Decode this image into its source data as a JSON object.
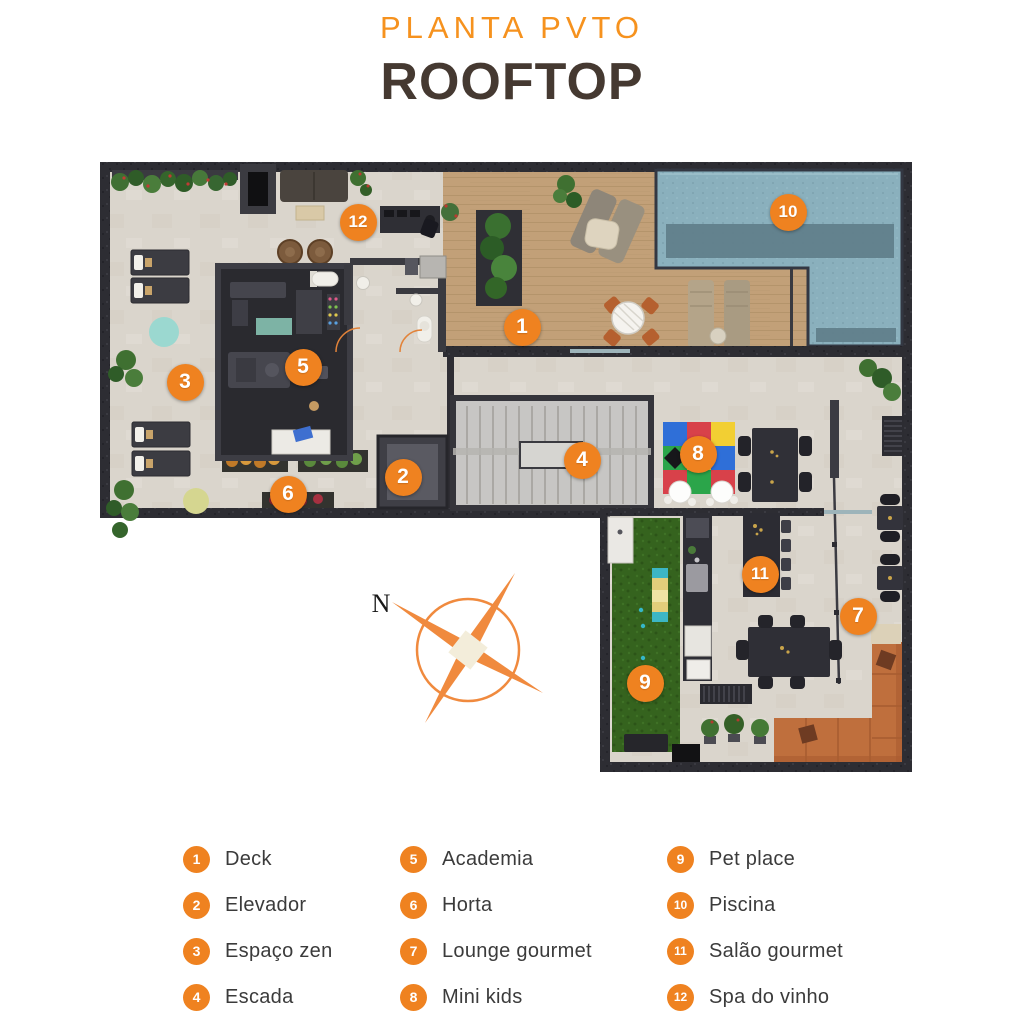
{
  "header": {
    "subtitle": "PLANTA PVTO",
    "title": "ROOFTOP"
  },
  "compass": {
    "north_label": "N"
  },
  "legend": {
    "items": [
      {
        "number": "1",
        "label": "Deck"
      },
      {
        "number": "2",
        "label": "Elevador"
      },
      {
        "number": "3",
        "label": "Espaço zen"
      },
      {
        "number": "4",
        "label": "Escada"
      },
      {
        "number": "5",
        "label": "Academia"
      },
      {
        "number": "6",
        "label": "Horta"
      },
      {
        "number": "7",
        "label": "Lounge gourmet"
      },
      {
        "number": "8",
        "label": "Mini kids"
      },
      {
        "number": "9",
        "label": "Pet place"
      },
      {
        "number": "10",
        "label": "Piscina"
      },
      {
        "number": "11",
        "label": "Salão gourmet"
      },
      {
        "number": "12",
        "label": "Spa do vinho"
      }
    ]
  },
  "plan": {
    "markers": [
      {
        "number": "1",
        "area": "deck",
        "x": 422,
        "y": 167
      },
      {
        "number": "2",
        "area": "elevador",
        "x": 303,
        "y": 317
      },
      {
        "number": "3",
        "area": "espaco-zen",
        "x": 85,
        "y": 222
      },
      {
        "number": "4",
        "area": "escada",
        "x": 482,
        "y": 300
      },
      {
        "number": "5",
        "area": "academia",
        "x": 203,
        "y": 207
      },
      {
        "number": "6",
        "area": "horta",
        "x": 188,
        "y": 334
      },
      {
        "number": "7",
        "area": "lounge-gourmet",
        "x": 758,
        "y": 456
      },
      {
        "number": "8",
        "area": "mini-kids",
        "x": 598,
        "y": 294
      },
      {
        "number": "9",
        "area": "pet-place",
        "x": 545,
        "y": 523
      },
      {
        "number": "10",
        "area": "piscina",
        "x": 688,
        "y": 52
      },
      {
        "number": "11",
        "area": "salao-gourmet",
        "x": 660,
        "y": 414
      },
      {
        "number": "12",
        "area": "spa-do-vinho",
        "x": 258,
        "y": 62
      }
    ]
  },
  "colors": {
    "accent": "#EF8220",
    "title_orange": "#F6921E",
    "title_brown": "#453931",
    "legend_text": "#3B3B3B",
    "wall": "#2D2D33",
    "floor": "#DAD5CC",
    "wood_deck": "#C2A078",
    "pool_water": "#8AB0BD",
    "pet_grass": "#36641F",
    "compass_orange": "#F08A3E"
  }
}
